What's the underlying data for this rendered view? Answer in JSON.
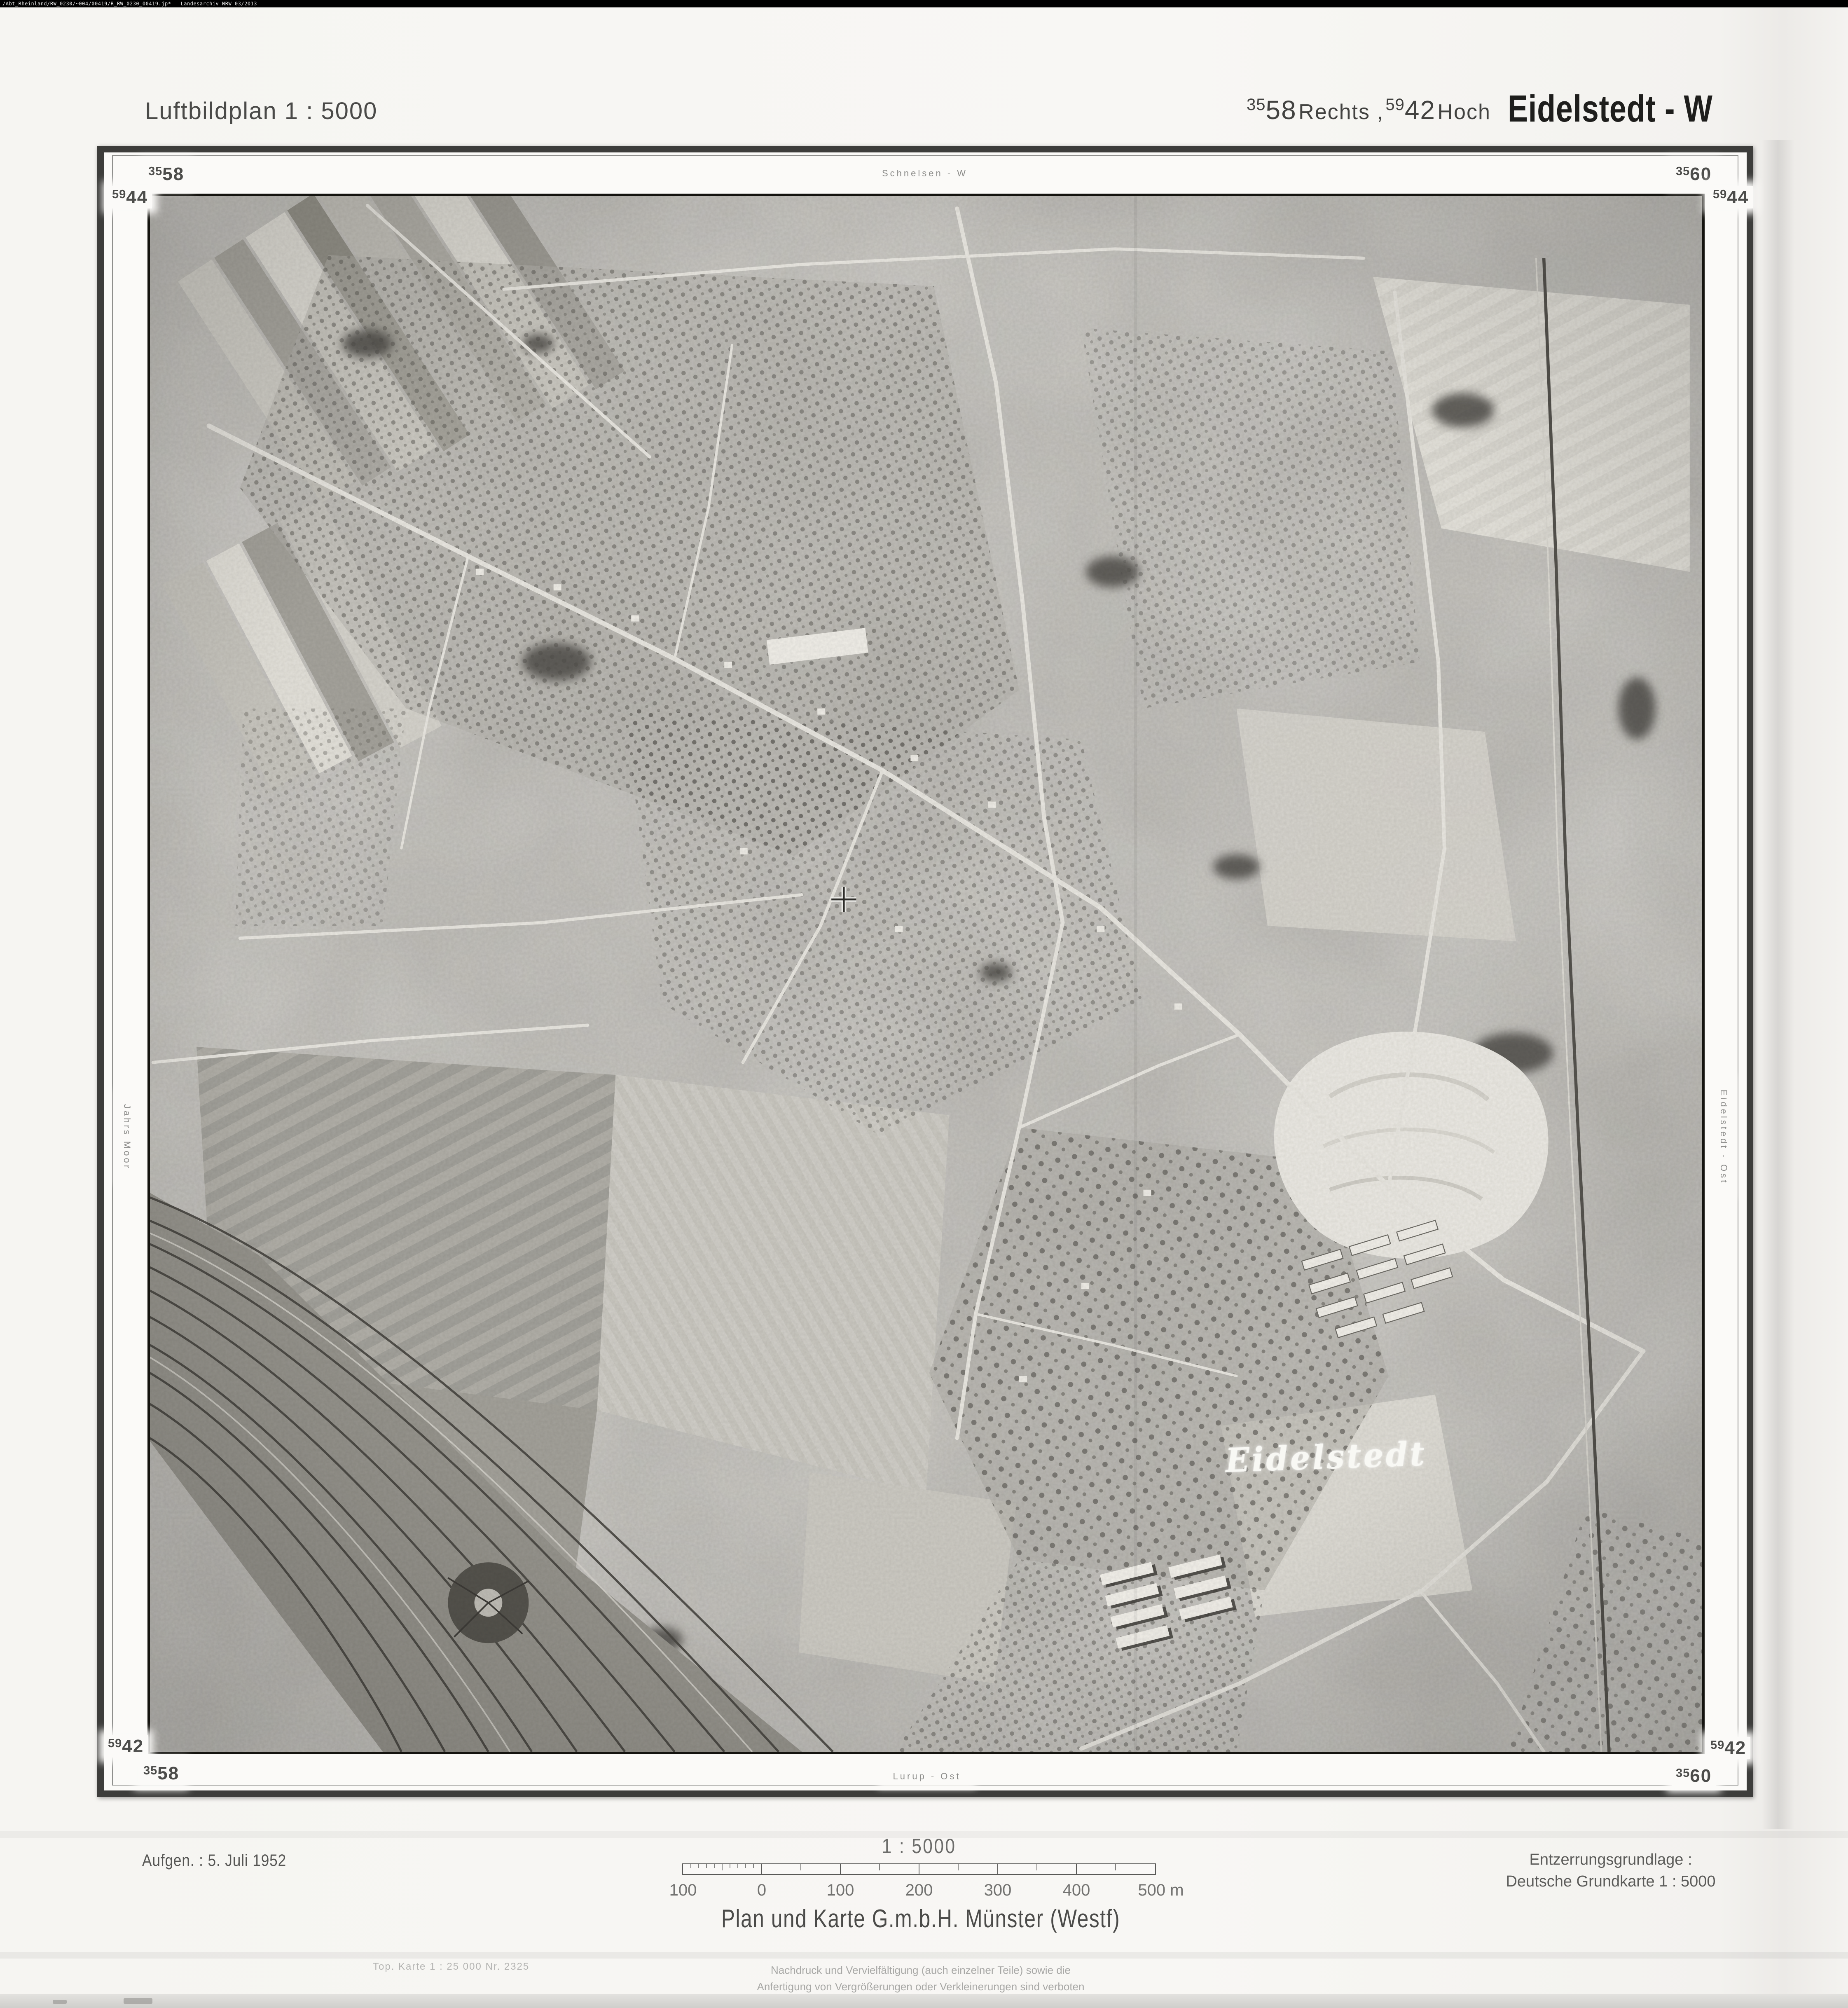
{
  "archive_strip": {
    "text": "/Abt_Rheinland/RW_0230/~004/00419/R_RW_0230_00419.jp* -  Landesarchiv NRW  03/2013"
  },
  "header": {
    "map_type": "Luftbildplan 1 : 5000",
    "grid_ref": {
      "rechts_sup": "35",
      "rechts_main": "58",
      "rechts_word": "Rechts ,",
      "hoch_sup": "59",
      "hoch_main": "42",
      "hoch_word": "Hoch"
    },
    "sheet_name": "Eidelstedt - W"
  },
  "frame": {
    "corner_coords": {
      "top_left_rechts": {
        "sup": "35",
        "main": "58"
      },
      "top_right_rechts": {
        "sup": "35",
        "main": "60"
      },
      "left_top_hoch": {
        "sup": "59",
        "main": "44"
      },
      "right_top_hoch": {
        "sup": "59",
        "main": "44"
      },
      "left_bottom_hoch": {
        "sup": "59",
        "main": "42"
      },
      "right_bottom_hoch": {
        "sup": "59",
        "main": "42"
      },
      "bottom_left_rechts": {
        "sup": "35",
        "main": "58"
      },
      "bottom_right_rechts": {
        "sup": "35",
        "main": "60"
      }
    },
    "neighbour_sheets": {
      "top": "Schnelsen - W",
      "left": "Jahrs Moor",
      "right": "Eidelstedt - Ost",
      "bottom": "Lurup - Ost"
    }
  },
  "photo": {
    "place_label": "Eidelstedt"
  },
  "footer": {
    "date": "Aufgen. : 5. Juli 1952",
    "scale_text": "1 : 5000",
    "scale_bar_labels": [
      "100",
      "0",
      "100",
      "200",
      "300",
      "400",
      "500 m"
    ],
    "rectification": {
      "line1": "Entzerrungsgrundlage :",
      "line2": "Deutsche Grundkarte 1 : 5000"
    },
    "publisher": "Plan und Karte G.m.b.H. Münster (Westf)",
    "topo_ref": "Top. Karte 1 : 25 000  Nr. 2325",
    "copyright": {
      "line1": "Nachdruck und Vervielfältigung (auch einzelner Teile) sowie die",
      "line2": "Anfertigung von Vergrößerungen oder Verkleinerungen sind verboten"
    }
  },
  "colors": {
    "page_background": "#f6f5f2",
    "archive_strip_bg": "#000000",
    "ink": "#3f3f3f",
    "frame_border": "#3d3d3b",
    "faint_ink": "#a8a8a6",
    "photo_base": "#c6c4bf",
    "photo_label": "#f8f8f4"
  }
}
